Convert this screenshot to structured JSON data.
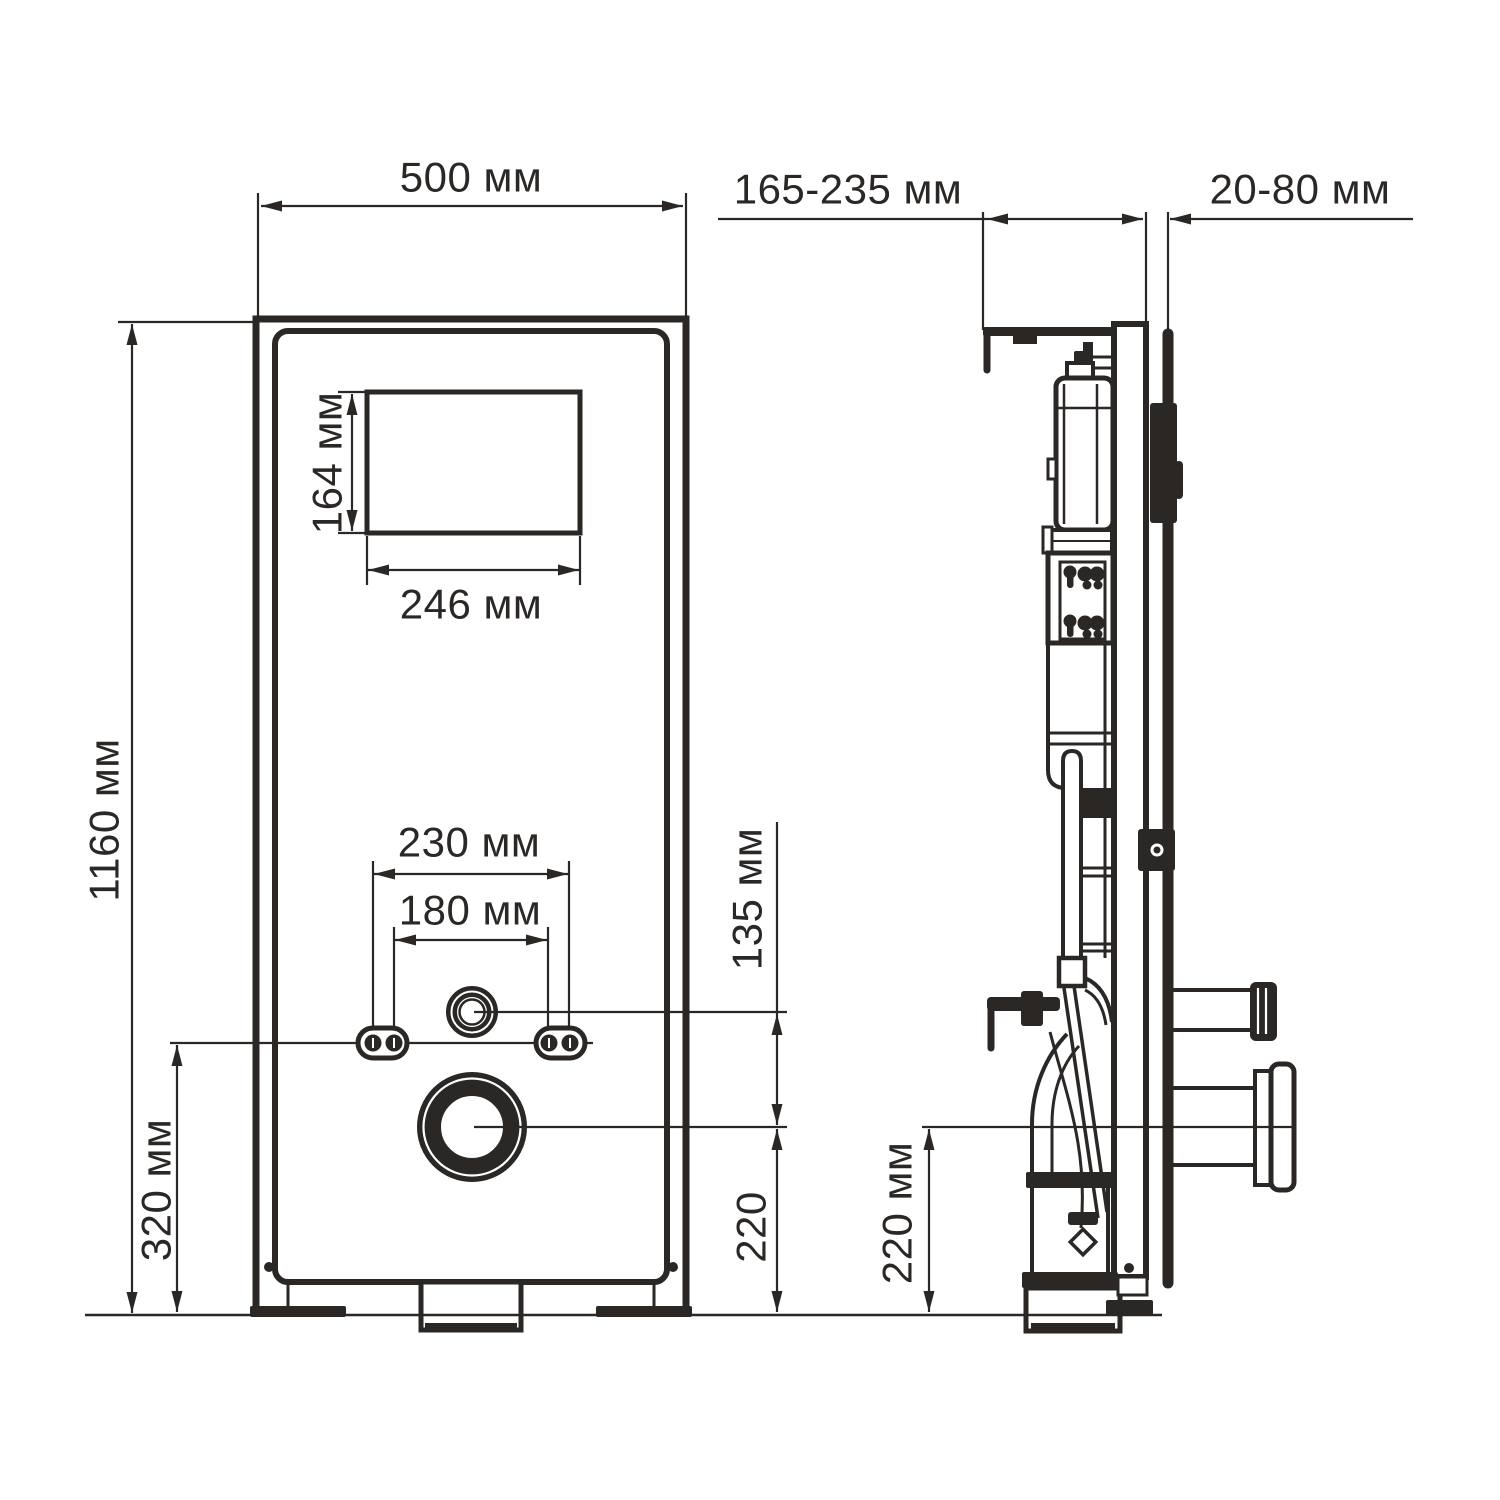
{
  "drawing": {
    "ink_color": "#2a2725",
    "background_color": "#ffffff",
    "front_view": {
      "width_label": "500 мм",
      "height_label": "1160 мм",
      "opening_height_label": "164 мм",
      "opening_width_label": "246 мм",
      "bolt_spacing_outer_label": "230 мм",
      "bolt_spacing_inner_label": "180 мм",
      "inlet_offset_label": "135 мм",
      "bolt_height_label": "320 мм",
      "outlet_height_label": "220"
    },
    "side_view": {
      "depth_range_label": "165-235 мм",
      "wall_distance_label": "20-80 мм",
      "outlet_height_label": "220 мм"
    }
  }
}
